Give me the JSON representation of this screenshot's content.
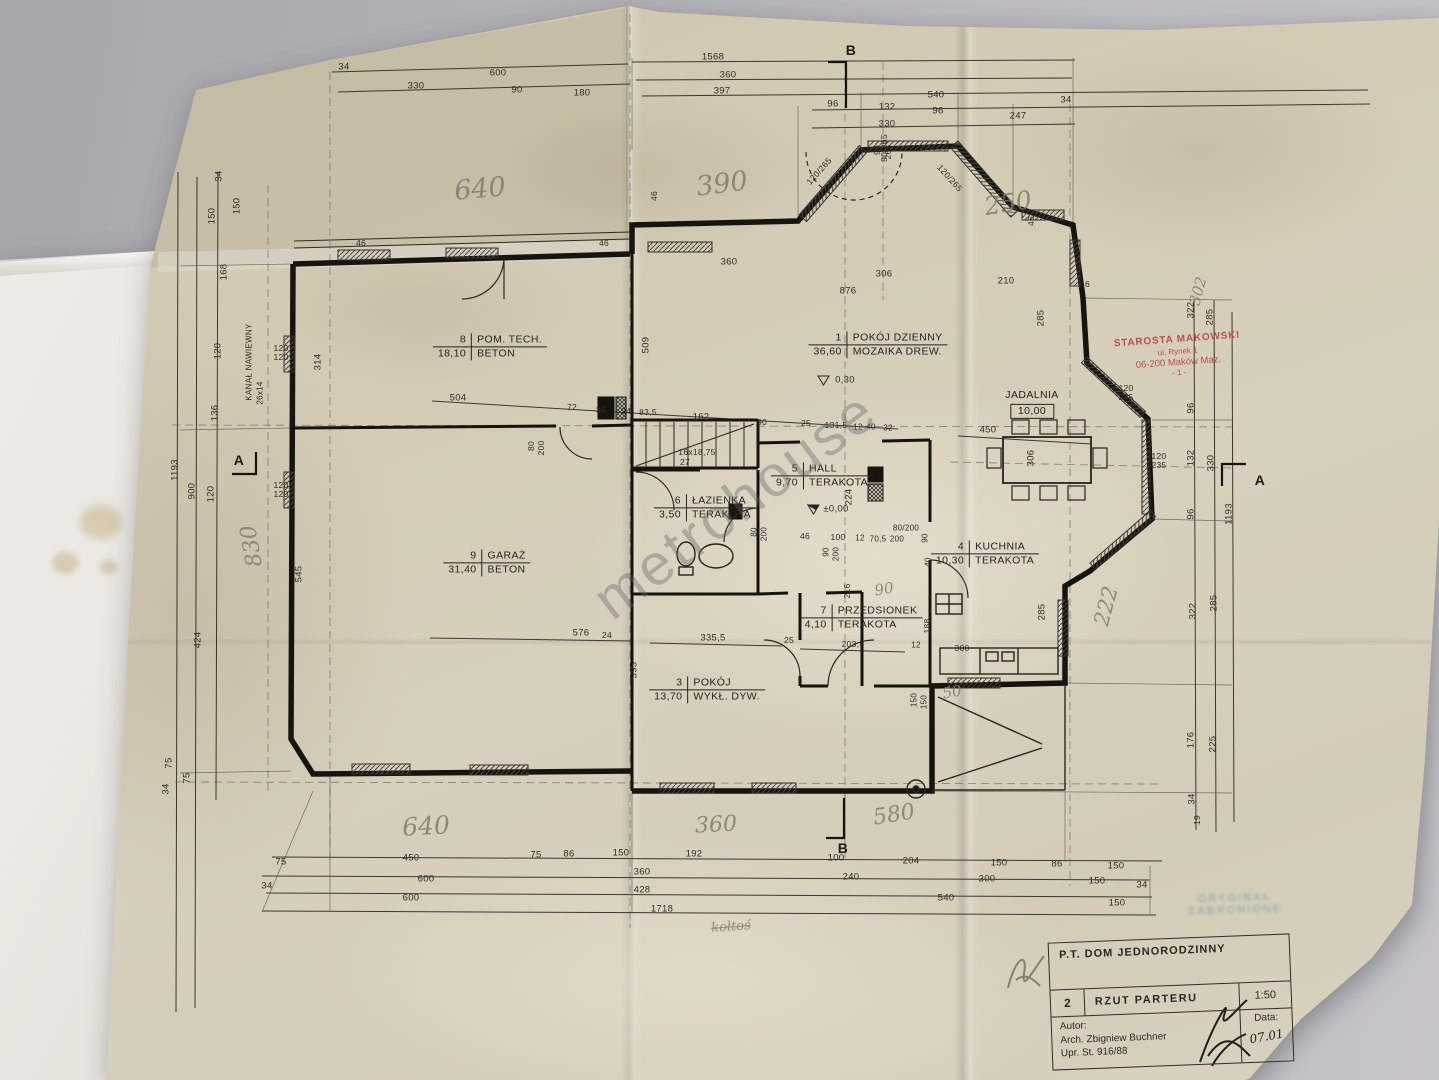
{
  "photo": {
    "watermark": "metrohouse"
  },
  "stamp_red": {
    "l1": "STAROSTA MAKOWSKI",
    "l2": "ul. Rynek 1",
    "l3": "06-200 Maków Maz.",
    "l4": "- 1 -"
  },
  "stamp_faint": {
    "l1": "ORYGINAŁ",
    "l2": "ZABRONIONE"
  },
  "title_block": {
    "project": "P.T. DOM JEDNORODZINNY",
    "no": "2",
    "drawing": "RZUT PARTERU",
    "scale": "1:50",
    "author_label": "Autor:",
    "author": "Arch. Zbigniew Buchner",
    "license": "Upr. St. 916/88",
    "date_label": "Data:",
    "date": "07.01"
  },
  "rooms": [
    {
      "num": "8",
      "name": "POM. TECH.",
      "area": "18,10",
      "fin": "BETON",
      "x": 490,
      "y": 347
    },
    {
      "num": "1",
      "name": "POKÓJ DZIENNY",
      "area": "36,60",
      "fin": "MOZAIKA DREW.",
      "x": 878,
      "y": 345
    },
    {
      "num": "9",
      "name": "GARAŻ",
      "area": "31,40",
      "fin": "BETON",
      "x": 487,
      "y": 563
    },
    {
      "num": "5",
      "name": "HALL",
      "area": "9,70",
      "fin": "TERAKOTA",
      "x": 822,
      "y": 476
    },
    {
      "num": "6",
      "name": "ŁAZIENKA",
      "area": "3,50",
      "fin": "TERAKOTA",
      "x": 705,
      "y": 508
    },
    {
      "num": "4",
      "name": "KUCHNIA",
      "area": "10,30",
      "fin": "TERAKOTA",
      "x": 985,
      "y": 554
    },
    {
      "num": "7",
      "name": "PRZEDSIONEK",
      "area": "4,10",
      "fin": "TERAKOTA",
      "x": 861,
      "y": 618
    },
    {
      "num": "3",
      "name": "POKÓJ",
      "area": "13,70",
      "fin": "WYKŁ. DYW.",
      "x": 707,
      "y": 690
    },
    {
      "boxed": true,
      "name": "JADALNIA",
      "area": "10,00",
      "x": 1032,
      "y": 404
    }
  ],
  "dims": [
    {
      "t": "1568",
      "x": 713,
      "y": 57
    },
    {
      "t": "360",
      "x": 728,
      "y": 75
    },
    {
      "t": "397",
      "x": 722,
      "y": 91
    },
    {
      "t": "540",
      "x": 936,
      "y": 95
    },
    {
      "t": "96",
      "x": 833,
      "y": 104
    },
    {
      "t": "132",
      "x": 887,
      "y": 107
    },
    {
      "t": "96",
      "x": 938,
      "y": 111
    },
    {
      "t": "34",
      "x": 1066,
      "y": 100
    },
    {
      "t": "247",
      "x": 1018,
      "y": 116
    },
    {
      "t": "330",
      "x": 887,
      "y": 124
    },
    {
      "t": "90",
      "x": 877,
      "y": 150,
      "r": -90,
      "s": 8.5
    },
    {
      "t": "265",
      "x": 888,
      "y": 152,
      "r": -90,
      "s": 8.5
    },
    {
      "t": "34",
      "x": 344,
      "y": 67
    },
    {
      "t": "600",
      "x": 498,
      "y": 73
    },
    {
      "t": "330",
      "x": 416,
      "y": 86
    },
    {
      "t": "90",
      "x": 517,
      "y": 90
    },
    {
      "t": "180",
      "x": 582,
      "y": 93
    },
    {
      "t": "34",
      "x": 219,
      "y": 176,
      "r": -90
    },
    {
      "t": "150",
      "x": 212,
      "y": 216,
      "r": -90
    },
    {
      "t": "150",
      "x": 237,
      "y": 206,
      "r": -90
    },
    {
      "t": "168",
      "x": 224,
      "y": 272,
      "r": -90
    },
    {
      "t": "120",
      "x": 218,
      "y": 351,
      "r": -90
    },
    {
      "t": "136",
      "x": 215,
      "y": 413,
      "r": -90
    },
    {
      "t": "1193",
      "x": 175,
      "y": 470,
      "r": -90
    },
    {
      "t": "900",
      "x": 192,
      "y": 491,
      "r": -90
    },
    {
      "t": "120",
      "x": 211,
      "y": 494,
      "r": -90
    },
    {
      "t": "424",
      "x": 198,
      "y": 640,
      "r": -90
    },
    {
      "t": "75",
      "x": 169,
      "y": 763,
      "r": -90
    },
    {
      "t": "75",
      "x": 187,
      "y": 778,
      "r": -90
    },
    {
      "t": "34",
      "x": 166,
      "y": 789,
      "r": -90
    },
    {
      "t": "KANAŁ NAWIEWNY",
      "x": 249,
      "y": 362,
      "r": -90,
      "s": 8
    },
    {
      "t": "26x14",
      "x": 260,
      "y": 393,
      "r": -90,
      "s": 8
    },
    {
      "t": "120",
      "x": 281,
      "y": 348,
      "s": 8.5
    },
    {
      "t": "120",
      "x": 281,
      "y": 357,
      "s": 8.5
    },
    {
      "t": "120",
      "x": 281,
      "y": 485,
      "s": 8.5
    },
    {
      "t": "120",
      "x": 281,
      "y": 494,
      "s": 8.5
    },
    {
      "t": "314",
      "x": 318,
      "y": 362,
      "r": -90
    },
    {
      "t": "545",
      "x": 299,
      "y": 574,
      "r": -90
    },
    {
      "t": "46",
      "x": 361,
      "y": 243,
      "s": 8.5
    },
    {
      "t": "46",
      "x": 604,
      "y": 243,
      "s": 8.5
    },
    {
      "t": "504",
      "x": 458,
      "y": 398
    },
    {
      "t": "72",
      "x": 572,
      "y": 407,
      "s": 8.5
    },
    {
      "t": "36",
      "x": 601,
      "y": 410,
      "s": 8.5
    },
    {
      "t": "24",
      "x": 626,
      "y": 411,
      "s": 8.5
    },
    {
      "t": "83,5",
      "x": 648,
      "y": 412,
      "s": 8.5
    },
    {
      "t": "162",
      "x": 701,
      "y": 417
    },
    {
      "t": "90",
      "x": 762,
      "y": 422,
      "s": 8.5
    },
    {
      "t": "25",
      "x": 806,
      "y": 423,
      "s": 8.5
    },
    {
      "t": "131,5",
      "x": 836,
      "y": 425,
      "s": 8.5
    },
    {
      "t": "12",
      "x": 858,
      "y": 427,
      "s": 8
    },
    {
      "t": "40",
      "x": 871,
      "y": 427,
      "s": 8
    },
    {
      "t": "32",
      "x": 888,
      "y": 428,
      "s": 8
    },
    {
      "t": "80",
      "x": 531,
      "y": 446,
      "r": -90,
      "s": 8.5
    },
    {
      "t": "200",
      "x": 541,
      "y": 448,
      "r": -90,
      "s": 8.5
    },
    {
      "t": "16x18,75",
      "x": 697,
      "y": 452,
      "s": 8.5
    },
    {
      "t": "27",
      "x": 685,
      "y": 462,
      "s": 8.5
    },
    {
      "t": "509",
      "x": 646,
      "y": 345,
      "r": -90
    },
    {
      "t": "46",
      "x": 654,
      "y": 196,
      "r": -90,
      "s": 8.5
    },
    {
      "t": "120/265",
      "x": 819,
      "y": 171,
      "r": -48,
      "s": 8.5
    },
    {
      "t": "90/265",
      "x": 884,
      "y": 148,
      "r": -90,
      "s": 8.5
    },
    {
      "t": "120/265",
      "x": 950,
      "y": 178,
      "r": 48,
      "s": 8.5
    },
    {
      "t": "46",
      "x": 1031,
      "y": 221,
      "r": -90,
      "s": 8.5
    },
    {
      "t": "360",
      "x": 729,
      "y": 262
    },
    {
      "t": "306",
      "x": 884,
      "y": 274
    },
    {
      "t": "210",
      "x": 1006,
      "y": 281
    },
    {
      "t": "876",
      "x": 848,
      "y": 291
    },
    {
      "t": "46",
      "x": 1085,
      "y": 284,
      "s": 8.5
    },
    {
      "t": "285",
      "x": 1041,
      "y": 318,
      "r": -90
    },
    {
      "t": "0,30",
      "x": 845,
      "y": 380
    },
    {
      "t": "±0,00",
      "x": 836,
      "y": 509
    },
    {
      "t": "224",
      "x": 849,
      "y": 497,
      "r": -90
    },
    {
      "t": "46",
      "x": 805,
      "y": 536,
      "s": 8.5
    },
    {
      "t": "100",
      "x": 838,
      "y": 537,
      "s": 8.5
    },
    {
      "t": "12",
      "x": 860,
      "y": 538,
      "s": 8
    },
    {
      "t": "70,5",
      "x": 878,
      "y": 539,
      "s": 8
    },
    {
      "t": "200",
      "x": 897,
      "y": 539,
      "s": 8
    },
    {
      "t": "90",
      "x": 826,
      "y": 552,
      "r": -90,
      "s": 8
    },
    {
      "t": "200",
      "x": 836,
      "y": 554,
      "r": -90,
      "s": 8
    },
    {
      "t": "216",
      "x": 847,
      "y": 591,
      "r": -90,
      "s": 8.5
    },
    {
      "t": "80",
      "x": 754,
      "y": 532,
      "r": -90,
      "s": 8
    },
    {
      "t": "200",
      "x": 764,
      "y": 534,
      "r": -90,
      "s": 8
    },
    {
      "t": "450",
      "x": 988,
      "y": 430
    },
    {
      "t": "306",
      "x": 1031,
      "y": 458,
      "r": -90
    },
    {
      "t": "120",
      "x": 1126,
      "y": 388,
      "s": 8.5
    },
    {
      "t": "235",
      "x": 1126,
      "y": 397,
      "s": 8.5
    },
    {
      "t": "120",
      "x": 1159,
      "y": 456,
      "s": 8.5
    },
    {
      "t": "235",
      "x": 1159,
      "y": 465,
      "s": 8.5
    },
    {
      "t": "80/200",
      "x": 906,
      "y": 528,
      "s": 8
    },
    {
      "t": "90",
      "x": 925,
      "y": 538,
      "r": -90,
      "s": 8
    },
    {
      "t": "40",
      "x": 928,
      "y": 562,
      "r": -90,
      "s": 8
    },
    {
      "t": "285",
      "x": 1042,
      "y": 612,
      "r": -90
    },
    {
      "t": "188",
      "x": 927,
      "y": 626,
      "r": -90,
      "s": 8.5
    },
    {
      "t": "12",
      "x": 916,
      "y": 645,
      "s": 8
    },
    {
      "t": "300",
      "x": 962,
      "y": 648,
      "s": 8.5
    },
    {
      "t": "203,5",
      "x": 853,
      "y": 644,
      "s": 8.5
    },
    {
      "t": "395",
      "x": 634,
      "y": 670,
      "r": -90
    },
    {
      "t": "24",
      "x": 607,
      "y": 635,
      "s": 8.5
    },
    {
      "t": "576",
      "x": 581,
      "y": 633
    },
    {
      "t": "335,5",
      "x": 713,
      "y": 638
    },
    {
      "t": "25",
      "x": 789,
      "y": 640,
      "s": 8.5
    },
    {
      "t": "150",
      "x": 914,
      "y": 700,
      "r": -90,
      "s": 8
    },
    {
      "t": "150",
      "x": 924,
      "y": 702,
      "r": -90,
      "s": 8
    },
    {
      "t": "322",
      "x": 1191,
      "y": 310,
      "r": -90
    },
    {
      "t": "285",
      "x": 1210,
      "y": 317,
      "r": -90
    },
    {
      "t": "96",
      "x": 1191,
      "y": 408,
      "r": -90
    },
    {
      "t": "132",
      "x": 1191,
      "y": 458,
      "r": -90
    },
    {
      "t": "330",
      "x": 1211,
      "y": 463,
      "r": -90
    },
    {
      "t": "96",
      "x": 1191,
      "y": 514,
      "r": -90
    },
    {
      "t": "1193",
      "x": 1229,
      "y": 514,
      "r": -90
    },
    {
      "t": "322",
      "x": 1193,
      "y": 611,
      "r": -90
    },
    {
      "t": "285",
      "x": 1214,
      "y": 603,
      "r": -90
    },
    {
      "t": "176",
      "x": 1191,
      "y": 740,
      "r": -90
    },
    {
      "t": "225",
      "x": 1213,
      "y": 744,
      "r": -90
    },
    {
      "t": "34",
      "x": 1192,
      "y": 799,
      "r": -90
    },
    {
      "t": "19",
      "x": 1197,
      "y": 820,
      "r": -90,
      "s": 8.5
    },
    {
      "t": "75",
      "x": 281,
      "y": 862
    },
    {
      "t": "450",
      "x": 411,
      "y": 858
    },
    {
      "t": "75",
      "x": 536,
      "y": 855
    },
    {
      "t": "86",
      "x": 569,
      "y": 854
    },
    {
      "t": "150",
      "x": 621,
      "y": 853
    },
    {
      "t": "192",
      "x": 694,
      "y": 854
    },
    {
      "t": "100",
      "x": 836,
      "y": 858
    },
    {
      "t": "204",
      "x": 911,
      "y": 861
    },
    {
      "t": "150",
      "x": 999,
      "y": 863
    },
    {
      "t": "86",
      "x": 1057,
      "y": 864
    },
    {
      "t": "150",
      "x": 1116,
      "y": 866
    },
    {
      "t": "34",
      "x": 267,
      "y": 886
    },
    {
      "t": "600",
      "x": 426,
      "y": 879
    },
    {
      "t": "360",
      "x": 642,
      "y": 872
    },
    {
      "t": "240",
      "x": 851,
      "y": 877
    },
    {
      "t": "300",
      "x": 987,
      "y": 879
    },
    {
      "t": "150",
      "x": 1097,
      "y": 881
    },
    {
      "t": "34",
      "x": 1142,
      "y": 885
    },
    {
      "t": "600",
      "x": 411,
      "y": 898
    },
    {
      "t": "428",
      "x": 642,
      "y": 890
    },
    {
      "t": "540",
      "x": 946,
      "y": 898
    },
    {
      "t": "150",
      "x": 1117,
      "y": 903
    },
    {
      "t": "1718",
      "x": 662,
      "y": 909
    }
  ],
  "sections": [
    {
      "t": "B",
      "x": 851,
      "y": 50
    },
    {
      "t": "A",
      "x": 239,
      "y": 460
    },
    {
      "t": "A",
      "x": 1260,
      "y": 480
    },
    {
      "t": "B",
      "x": 843,
      "y": 848
    }
  ],
  "handwritten": [
    {
      "t": "640",
      "x": 480,
      "y": 189,
      "s": 27,
      "r": -5
    },
    {
      "t": "390",
      "x": 722,
      "y": 184,
      "s": 27,
      "r": -7
    },
    {
      "t": "250",
      "x": 1008,
      "y": 203,
      "s": 25,
      "r": -9
    },
    {
      "t": "830",
      "x": 252,
      "y": 546,
      "s": 22,
      "r": -100
    },
    {
      "t": "222",
      "x": 1106,
      "y": 606,
      "s": 21,
      "r": -75
    },
    {
      "t": "302",
      "x": 1198,
      "y": 291,
      "s": 15,
      "r": -75
    },
    {
      "t": "640",
      "x": 426,
      "y": 826,
      "s": 25,
      "r": -3
    },
    {
      "t": "360",
      "x": 716,
      "y": 825,
      "s": 22,
      "r": -3
    },
    {
      "t": "580",
      "x": 894,
      "y": 815,
      "s": 22,
      "r": -9
    },
    {
      "t": "90",
      "x": 884,
      "y": 589,
      "s": 15,
      "r": -10
    },
    {
      "t": "50",
      "x": 952,
      "y": 692,
      "s": 15,
      "r": -10
    },
    {
      "t": "kołtoś",
      "x": 731,
      "y": 927,
      "s": 13,
      "r": -4,
      "strike": 1
    }
  ]
}
